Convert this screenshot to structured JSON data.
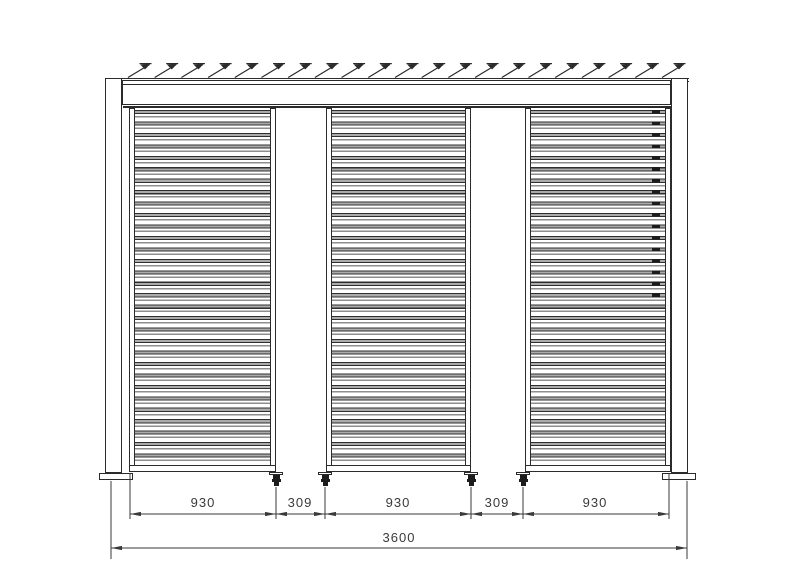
{
  "drawing": {
    "type": "louvered-pergola-wall-front-elevation",
    "colors": {
      "line": "#2b2b2b",
      "slat_fill": "#ababab",
      "background": "#ffffff"
    },
    "dimensions": {
      "row1": [
        {
          "label": "930"
        },
        {
          "label": "309"
        },
        {
          "label": "930"
        },
        {
          "label": "309"
        },
        {
          "label": "930"
        }
      ],
      "overall": {
        "label": "3600"
      }
    }
  }
}
